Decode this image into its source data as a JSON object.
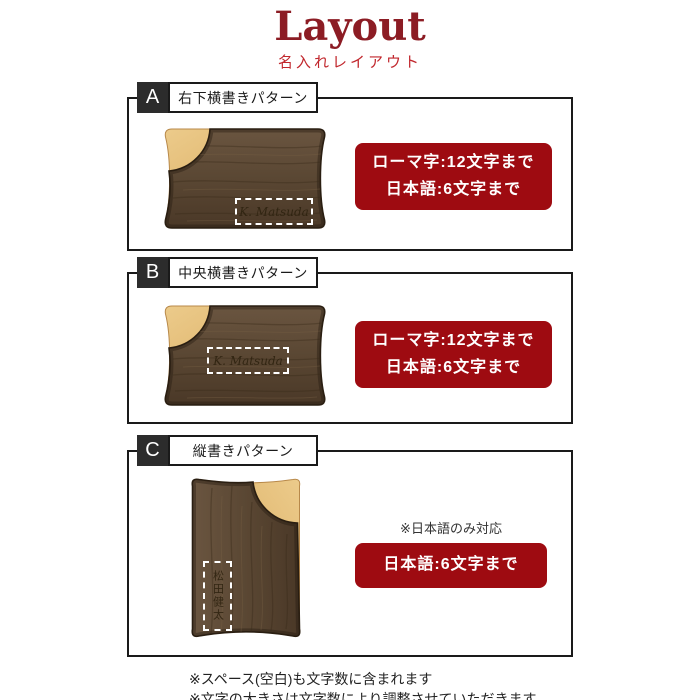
{
  "page": {
    "title": "Layout",
    "subtitle": "名入れレイアウト"
  },
  "colors": {
    "accent_red": "#9e0b11",
    "title_red": "#8c1c24",
    "subtitle_red": "#c1272d",
    "walnut_brown": "#5a4733",
    "maple_tan": "#e0b269",
    "border_black": "#1a1a1a"
  },
  "sections": [
    {
      "label": "A",
      "title": "右下横書きパターン",
      "engraving": "K. Matsuda",
      "limits": [
        "ローマ字:12文字まで",
        "日本語:6文字まで"
      ]
    },
    {
      "label": "B",
      "title": "中央横書きパターン",
      "engraving": "K. Matsuda",
      "limits": [
        "ローマ字:12文字まで",
        "日本語:6文字まで"
      ]
    },
    {
      "label": "C",
      "title": "縦書きパターン",
      "engraving": "松田健太",
      "note": "※日本語のみ対応",
      "limits": [
        "日本語:6文字まで"
      ]
    }
  ],
  "footnotes": [
    "※スペース(空白)も文字数に含まれます",
    "※文字の大きさは文字数により調整させていただきます"
  ]
}
